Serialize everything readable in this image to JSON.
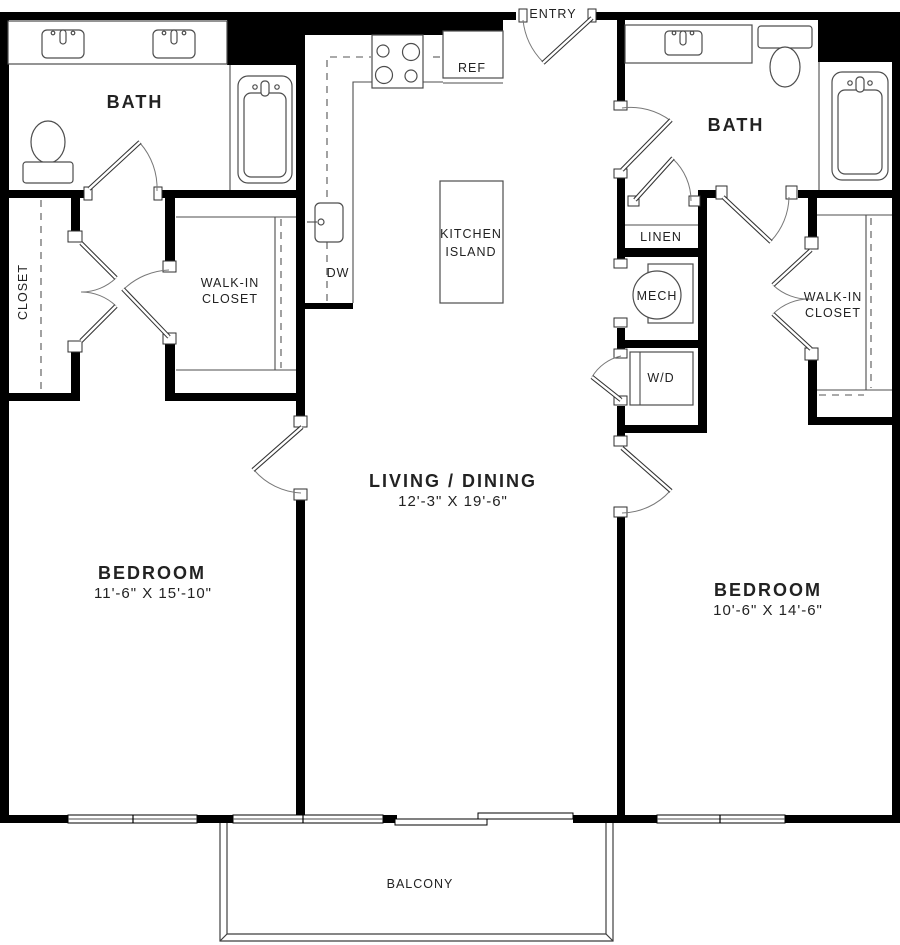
{
  "plan": {
    "entry": {
      "label": "ENTRY"
    },
    "kitchen": {
      "ref_label": "REF",
      "dw_label": "DW",
      "island_label_line1": "KITCHEN",
      "island_label_line2": "ISLAND"
    },
    "baths": {
      "left_label": "BATH",
      "right_label": "BATH"
    },
    "utility": {
      "linen_label": "LINEN",
      "mech_label": "MECH",
      "washer_dryer_label": "W/D"
    },
    "closets": {
      "left_closet_label": "CLOSET",
      "left_walkin_line1": "WALK-IN",
      "left_walkin_line2": "CLOSET",
      "right_walkin_line1": "WALK-IN",
      "right_walkin_line2": "CLOSET"
    },
    "living_dining": {
      "label": "LIVING / DINING",
      "dimensions": "12'-3\" X 19'-6\""
    },
    "bedroom_left": {
      "label": "BEDROOM",
      "dimensions": "11'-6\" X 15'-10\""
    },
    "bedroom_right": {
      "label": "BEDROOM",
      "dimensions": "10'-6\" X 14'-6\""
    },
    "balcony": {
      "label": "BALCONY"
    },
    "colors": {
      "wall": "#000000",
      "fixture_line": "#4d4d4d",
      "text": "#222222",
      "background": "#ffffff"
    }
  }
}
